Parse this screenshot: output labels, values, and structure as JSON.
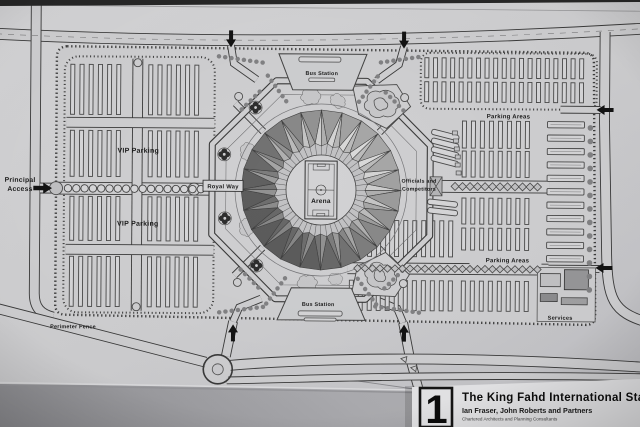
{
  "drawing": {
    "labels": {
      "principal_access_line1": "Principal",
      "principal_access_line2": "Access",
      "vip_parking": "VIP Parking",
      "royal_way": "Royal Way",
      "arena": "Arena",
      "bus_station": "Bus Station",
      "officials_line1": "Officials and",
      "officials_line2": "Competitors",
      "parking_areas": "Parking Areas",
      "services": "Services",
      "perimeter_fence": "Perimeter Fence"
    },
    "colors": {
      "paper": "#d0d0d2",
      "ink": "#3a3a3a",
      "roof_light": "#c9c9cb",
      "roof_dark": "#8c8c8e",
      "backing": "#a9a9ad",
      "card": "#e7e7e9"
    }
  },
  "title_block": {
    "sheet_number": "1",
    "title": "The King Fahd International Stadium",
    "architects": "Ian Fraser, John Roberts and Partners",
    "consultants": "Chartered Architects and Planning Consultants"
  }
}
